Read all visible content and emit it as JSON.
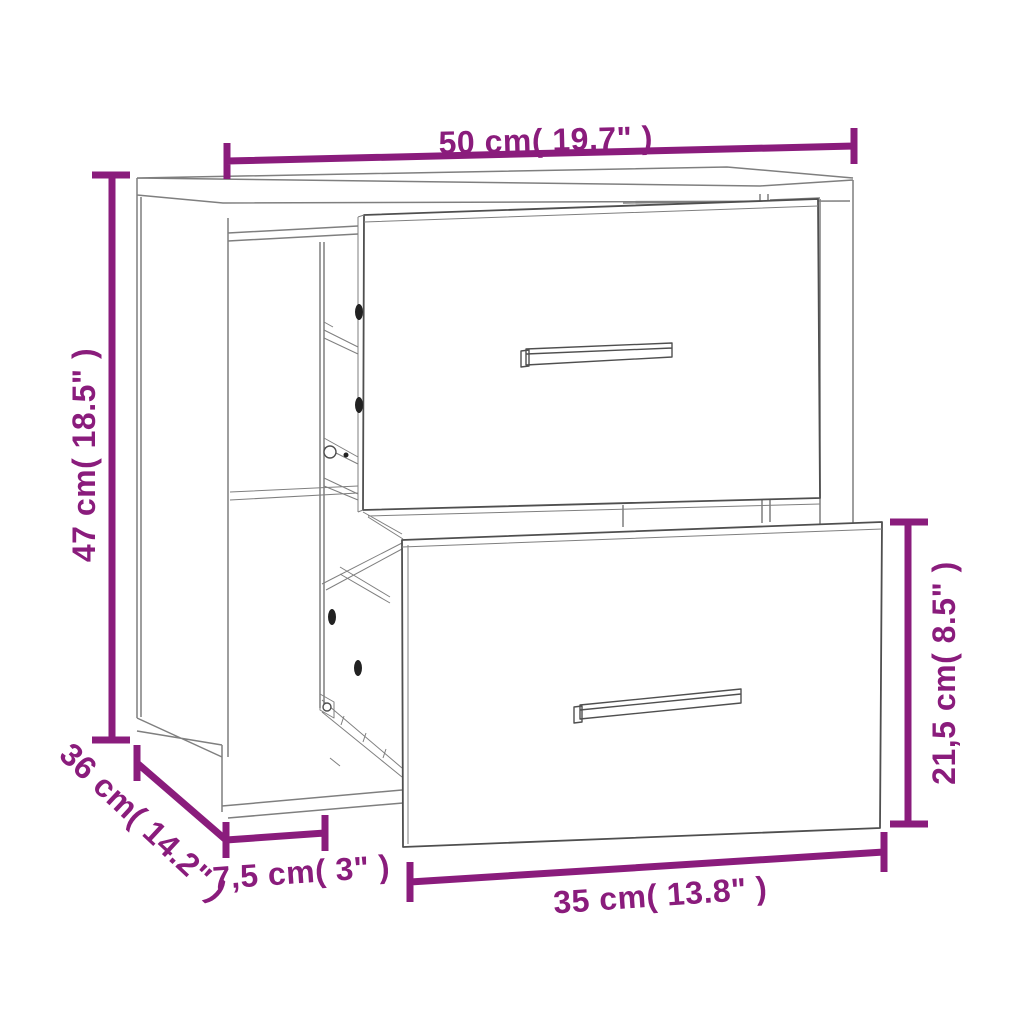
{
  "diagram": {
    "type": "furniture-dimension-diagram",
    "subject": "wall-mounted-bedside-cabinet-two-drawers",
    "colors": {
      "dimension": "#8A1C7C",
      "outline": "#7F7F7F",
      "outline_dark": "#4F4F4F",
      "fill": "#FFFFFF",
      "hole": "#222222"
    },
    "dimensions": {
      "width": {
        "label": "50 cm( 19.7\" )"
      },
      "height": {
        "label": "47 cm( 18.5\" )"
      },
      "depth": {
        "label": "36 cm( 14.2\" )"
      },
      "side_depth": {
        "label": "7,5 cm( 3\" )"
      },
      "drawer_width": {
        "label": "35 cm( 13.8\" )"
      },
      "drawer_height": {
        "label": "21,5 cm( 8.5\" )"
      }
    }
  }
}
